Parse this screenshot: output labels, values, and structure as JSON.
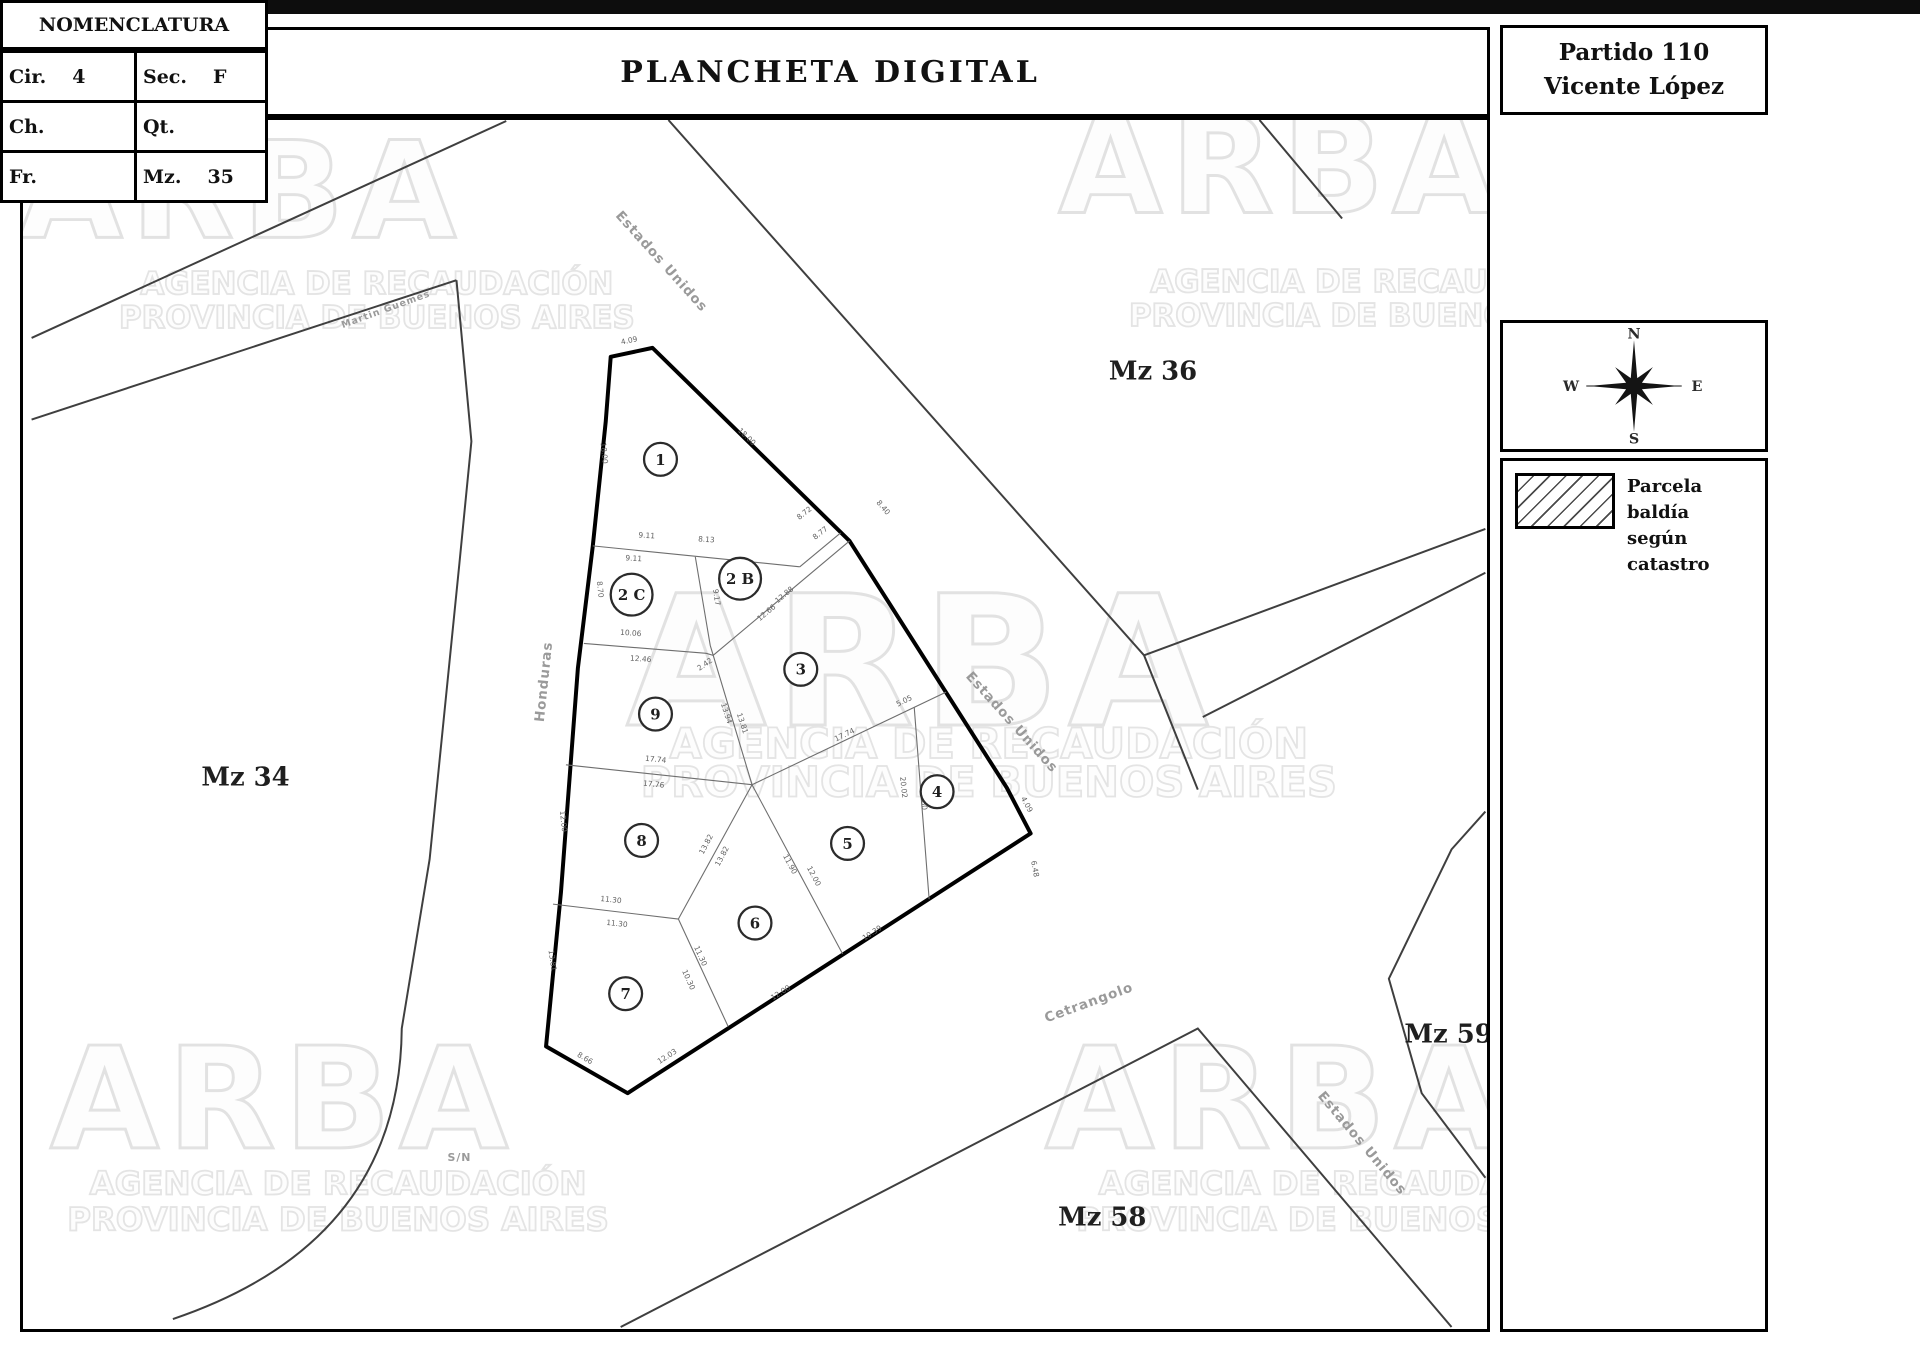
{
  "header": {
    "logo": "ARBA",
    "logo_color": "#29b9d0",
    "title": "PLANCHETA DIGITAL"
  },
  "panel": {
    "partido_line1": "Partido 110",
    "partido_line2": "Vicente López",
    "nomenclatura_title": "NOMENCLATURA",
    "fields": [
      {
        "label": "Cir.",
        "value": "4"
      },
      {
        "label": "Sec.",
        "value": "F"
      },
      {
        "label": "Ch.",
        "value": ""
      },
      {
        "label": "Qt.",
        "value": ""
      },
      {
        "label": "Fr.",
        "value": ""
      },
      {
        "label": "Mz.",
        "value": "35"
      }
    ],
    "compass": {
      "n": "N",
      "e": "E",
      "s": "S",
      "w": "W"
    },
    "legend": {
      "line1": "Parcela baldía",
      "line2": "según catastro"
    }
  },
  "map": {
    "blocks": [
      {
        "label": "Mz 17",
        "x": 182,
        "y": 196
      },
      {
        "label": "Mz 36",
        "x": 1155,
        "y": 378
      },
      {
        "label": "Mz 34",
        "x": 243,
        "y": 786
      },
      {
        "label": "Mz 59",
        "x": 1452,
        "y": 1044
      },
      {
        "label": "Mz 58",
        "x": 1104,
        "y": 1228
      }
    ],
    "streets": [
      {
        "name": "Estados Unidos",
        "x": 658,
        "y": 262,
        "rot": 48,
        "fs": 13.5
      },
      {
        "name": "Estados Unidos",
        "x": 1010,
        "y": 725,
        "rot": 48,
        "fs": 13.5
      },
      {
        "name": "Estados Unidos",
        "x": 1362,
        "y": 1148,
        "rot": 50,
        "fs": 13.5
      },
      {
        "name": "Honduras",
        "x": 547,
        "y": 682,
        "rot": -84,
        "fs": 13.5
      },
      {
        "name": "Cetrangolo",
        "x": 1092,
        "y": 1008,
        "rot": -20,
        "fs": 13.5
      },
      {
        "name": "Martin Guemes",
        "x": 385,
        "y": 310,
        "rot": -20,
        "fs": 9.5
      },
      {
        "name": "S/N",
        "x": 458,
        "y": 1163,
        "rot": 0,
        "fs": 11
      }
    ],
    "parcels": [
      {
        "label": "1",
        "x": 660,
        "y": 458
      },
      {
        "label": "2 B",
        "x": 740,
        "y": 578
      },
      {
        "label": "2 C",
        "x": 631,
        "y": 594
      },
      {
        "label": "3",
        "x": 801,
        "y": 669
      },
      {
        "label": "9",
        "x": 655,
        "y": 714
      },
      {
        "label": "8",
        "x": 641,
        "y": 841
      },
      {
        "label": "5",
        "x": 848,
        "y": 844
      },
      {
        "label": "6",
        "x": 755,
        "y": 924
      },
      {
        "label": "7",
        "x": 625,
        "y": 995
      },
      {
        "label": "4",
        "x": 938,
        "y": 792
      }
    ],
    "dims": [
      {
        "v": "4.09",
        "x": 629,
        "y": 341,
        "r": -12
      },
      {
        "v": "18.00",
        "x": 745,
        "y": 437,
        "r": 44
      },
      {
        "v": "18.00",
        "x": 601,
        "y": 452,
        "r": 84
      },
      {
        "v": "9.11",
        "x": 646,
        "y": 537,
        "r": 4
      },
      {
        "v": "9.11",
        "x": 633,
        "y": 560,
        "r": 4
      },
      {
        "v": "8.13",
        "x": 706,
        "y": 541,
        "r": 4
      },
      {
        "v": "8.72",
        "x": 806,
        "y": 514,
        "r": -38
      },
      {
        "v": "8.77",
        "x": 822,
        "y": 534,
        "r": -38
      },
      {
        "v": "8.40",
        "x": 882,
        "y": 508,
        "r": 50
      },
      {
        "v": "8.70",
        "x": 597,
        "y": 589,
        "r": 84
      },
      {
        "v": "9.17",
        "x": 714,
        "y": 597,
        "r": 82
      },
      {
        "v": "10.06",
        "x": 630,
        "y": 635,
        "r": 4
      },
      {
        "v": "2.42",
        "x": 706,
        "y": 666,
        "r": -35
      },
      {
        "v": "12.46",
        "x": 640,
        "y": 661,
        "r": 4
      },
      {
        "v": "12.66",
        "x": 768,
        "y": 614,
        "r": -40
      },
      {
        "v": "12.88",
        "x": 786,
        "y": 596,
        "r": -40
      },
      {
        "v": "12.00",
        "x": 560,
        "y": 822,
        "r": 84
      },
      {
        "v": "13.94",
        "x": 724,
        "y": 714,
        "r": 72
      },
      {
        "v": "13.81",
        "x": 740,
        "y": 724,
        "r": 72
      },
      {
        "v": "17.74",
        "x": 655,
        "y": 762,
        "r": 6
      },
      {
        "v": "17.76",
        "x": 653,
        "y": 787,
        "r": 6
      },
      {
        "v": "17.74",
        "x": 846,
        "y": 737,
        "r": -26
      },
      {
        "v": "5.05",
        "x": 906,
        "y": 703,
        "r": -26
      },
      {
        "v": "13.82",
        "x": 708,
        "y": 846,
        "r": -62
      },
      {
        "v": "13.82",
        "x": 724,
        "y": 858,
        "r": -62
      },
      {
        "v": "11.30",
        "x": 610,
        "y": 903,
        "r": 6
      },
      {
        "v": "11.30",
        "x": 616,
        "y": 927,
        "r": 6
      },
      {
        "v": "11.30",
        "x": 698,
        "y": 958,
        "r": 66
      },
      {
        "v": "10.30",
        "x": 686,
        "y": 982,
        "r": 66
      },
      {
        "v": "11.90",
        "x": 788,
        "y": 866,
        "r": 62
      },
      {
        "v": "12.00",
        "x": 812,
        "y": 878,
        "r": 62
      },
      {
        "v": "20.02",
        "x": 902,
        "y": 788,
        "r": 84
      },
      {
        "v": "34.60",
        "x": 922,
        "y": 800,
        "r": 84
      },
      {
        "v": "10.39",
        "x": 874,
        "y": 936,
        "r": -33
      },
      {
        "v": "12.00",
        "x": 782,
        "y": 996,
        "r": -33
      },
      {
        "v": "12.03",
        "x": 668,
        "y": 1060,
        "r": -33
      },
      {
        "v": "8.66",
        "x": 583,
        "y": 1062,
        "r": 30
      },
      {
        "v": "13.81",
        "x": 549,
        "y": 962,
        "r": 82
      },
      {
        "v": "6.48",
        "x": 1034,
        "y": 870,
        "r": 80
      },
      {
        "v": "4.09",
        "x": 1026,
        "y": 806,
        "r": 62
      }
    ],
    "watermark": {
      "word": "ARBA",
      "line1": "AGENCIA DE RECAUDACIÓN",
      "line2": "PROVINCIA DE BUENOS AIRES",
      "tiles": [
        {
          "wx": 285,
          "wy": 235,
          "lx": 375,
          "l1y": 292,
          "l2y": 326,
          "s": 1
        },
        {
          "wx": 1330,
          "wy": 210,
          "lx": 1390,
          "l1y": 290,
          "l2y": 324,
          "s": 1
        },
        {
          "wx": 990,
          "wy": 725,
          "lx": 990,
          "l1y": 758,
          "l2y": 797,
          "s": 1.35
        },
        {
          "wx": 330,
          "wy": 1150,
          "lx": 336,
          "l1y": 1197,
          "l2y": 1233,
          "s": 1.05
        },
        {
          "wx": 1330,
          "wy": 1150,
          "lx": 1350,
          "l1y": 1197,
          "l2y": 1233,
          "s": 1.05
        }
      ]
    }
  }
}
